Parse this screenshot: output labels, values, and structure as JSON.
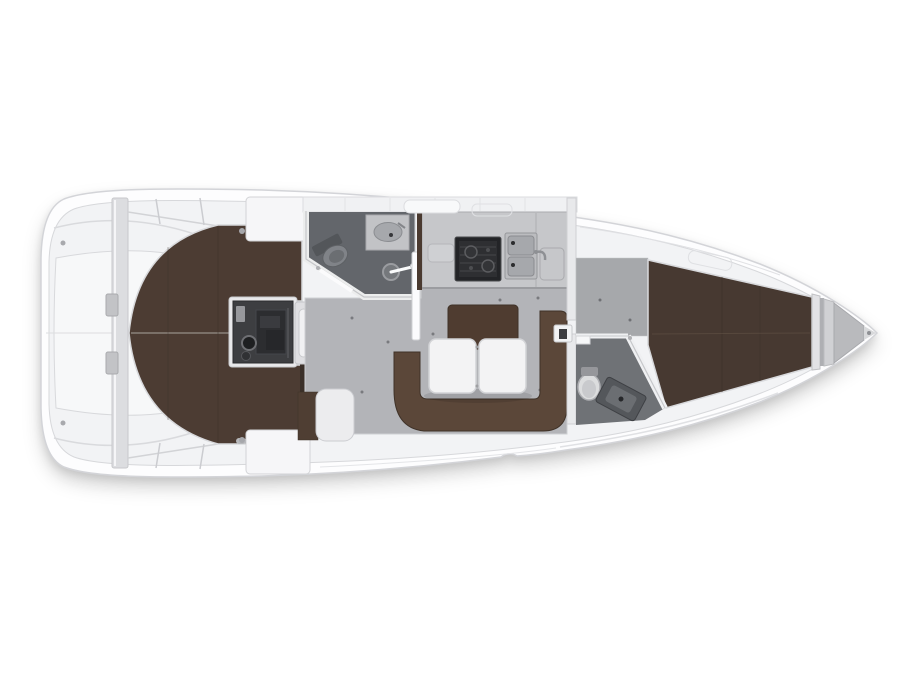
{
  "page": {
    "background": "#ffffff"
  },
  "diagram": {
    "type": "yacht-floor-plan",
    "view": "top-down",
    "bow_direction": "right",
    "stern_direction": "left"
  },
  "areas": [
    {
      "id": "stern-cockpit",
      "label": "stern cockpit / transom platform"
    },
    {
      "id": "aft-cabin",
      "label": "aft double-berth cabin"
    },
    {
      "id": "engine-compartment",
      "label": "engine compartment under companionway"
    },
    {
      "id": "companionway-steps",
      "label": "companionway steps"
    },
    {
      "id": "aft-head",
      "label": "aft head with toilet, washbasin and shower"
    },
    {
      "id": "galley",
      "label": "galley with stove and double sink"
    },
    {
      "id": "salon",
      "label": "salon with U-settee and folding table"
    },
    {
      "id": "nav-seat",
      "label": "navigation seat"
    },
    {
      "id": "forward-head",
      "label": "forward head with toilet and washbasin"
    },
    {
      "id": "forward-cabin",
      "label": "forward V-berth cabin"
    },
    {
      "id": "anchor-locker",
      "label": "bow anchor locker"
    }
  ],
  "colors": {
    "background": "#ffffff",
    "hull_fill": "#fdfdfe",
    "hull_stroke": "#d3d4d8",
    "inner_fill": "#f2f3f5",
    "inner_stroke": "#d7d8db",
    "stern_platform": "#f7f8f9",
    "bulkhead_fill": "#dcdde0",
    "locker_white": "#f6f6f8",
    "berth_aft": "#4c3c33",
    "berth_fwd": "#473931",
    "settee_fill": "#5b4739",
    "settee_back": "#4f3c30",
    "doorway_dark": "#3a2f28",
    "bench_brown": "#4f3e33",
    "seat_white": "#ececee",
    "engine_fill": "#3d3e41",
    "steps_fill": "#f1f1f3",
    "head_floor": "#63666b",
    "head_floor_fwd": "#6f7276",
    "floor_salon": "#b3b4b8",
    "floor_fwd": "#a6a8ab",
    "counter": "#c6c7ca",
    "stove_dark": "#232427",
    "sink_frame": "#bbbcbf",
    "basin_gray": "#a6a8ac",
    "toilet_gray": "#808388",
    "toilet_white": "#dcddde",
    "shower_gray": "#75787c",
    "table_white": "#f3f3f4",
    "wood_trim": "#4a3a30",
    "bow_locker": "#b9babd",
    "wall_white": "#eff0f2",
    "metal": "#8e9094"
  }
}
